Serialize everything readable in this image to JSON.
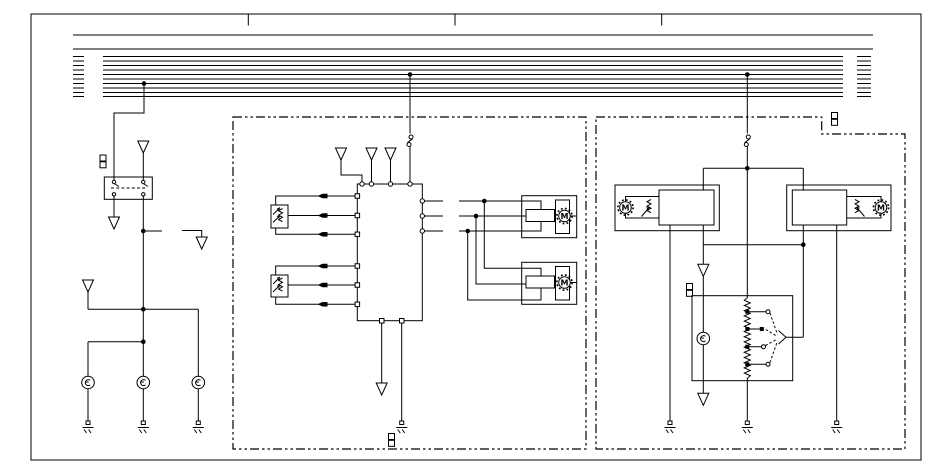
{
  "colors": {
    "background": "#ffffff",
    "ink": "#000000"
  },
  "labels": {
    "motor": "M"
  },
  "structure": {
    "bus_line_count": 12,
    "bus_tap_count": 3,
    "frame_tick_count": 3,
    "sections": [
      "left-relay-circuit",
      "center-control-module",
      "right-module"
    ],
    "symbol_counts": {
      "off_page_arrows": 10,
      "bulbs": 4,
      "motors": 4,
      "ground_points": 7,
      "junction_dots": 11,
      "inline_connector_arrows": 6,
      "connector_square_markers": 4,
      "connector_circle_pairs": 2
    }
  }
}
